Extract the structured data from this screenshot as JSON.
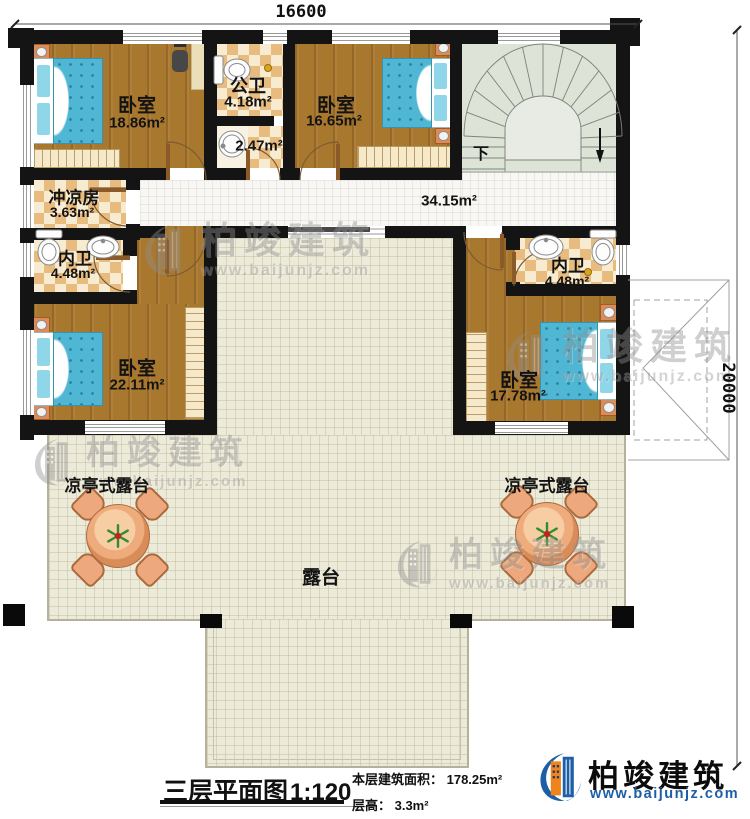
{
  "dimensions": {
    "width": "16600",
    "height": "20000"
  },
  "rooms": {
    "bedroom_top_left": {
      "name": "卧室",
      "area": "18.86m²"
    },
    "public_bathroom": {
      "name": "公卫",
      "area": "4.18m²"
    },
    "washroom": {
      "area": "2.47m²"
    },
    "bedroom_top_right": {
      "name": "卧室",
      "area": "16.65m²"
    },
    "shower_room": {
      "name": "冲凉房",
      "area": "3.63m²"
    },
    "hallway": {
      "area": "34.15m²"
    },
    "ensuite_left": {
      "name": "内卫",
      "area": "4.48m²"
    },
    "ensuite_right": {
      "name": "内卫",
      "area": "4.48m²"
    },
    "bedroom_bottom_left": {
      "name": "卧室",
      "area": "22.11m²"
    },
    "bedroom_bottom_right": {
      "name": "卧室",
      "area": "17.78m²"
    },
    "pavilion_terrace_left": {
      "name": "凉亭式露台"
    },
    "pavilion_terrace_right": {
      "name": "凉亭式露台"
    },
    "terrace": {
      "name": "露台"
    }
  },
  "stairs": {
    "down_label": "下"
  },
  "footer": {
    "title": "三层平面图",
    "scale": "1:120",
    "floor_area": "本层建筑面积： 178.25m²",
    "floor_height": "层高： 3.3m²"
  },
  "brand": {
    "name": "柏竣建筑",
    "website": "www.baijunjz.com"
  },
  "watermark": {
    "name": "柏竣建筑",
    "website": "www.baijunjz.com"
  },
  "colors": {
    "wall": "#141414",
    "wood_floor": "#a9782f",
    "tile_light": "#f7ecd2",
    "tile_dark": "#e8bc7f",
    "terrace_floor": "#ecead9",
    "stair_floor": "#dde3d7",
    "bed_blue": "#4fb7d4",
    "furniture_orange": "#dd8b57",
    "logo_blue": "#1c5fa6",
    "logo_orange": "#ef831c"
  }
}
